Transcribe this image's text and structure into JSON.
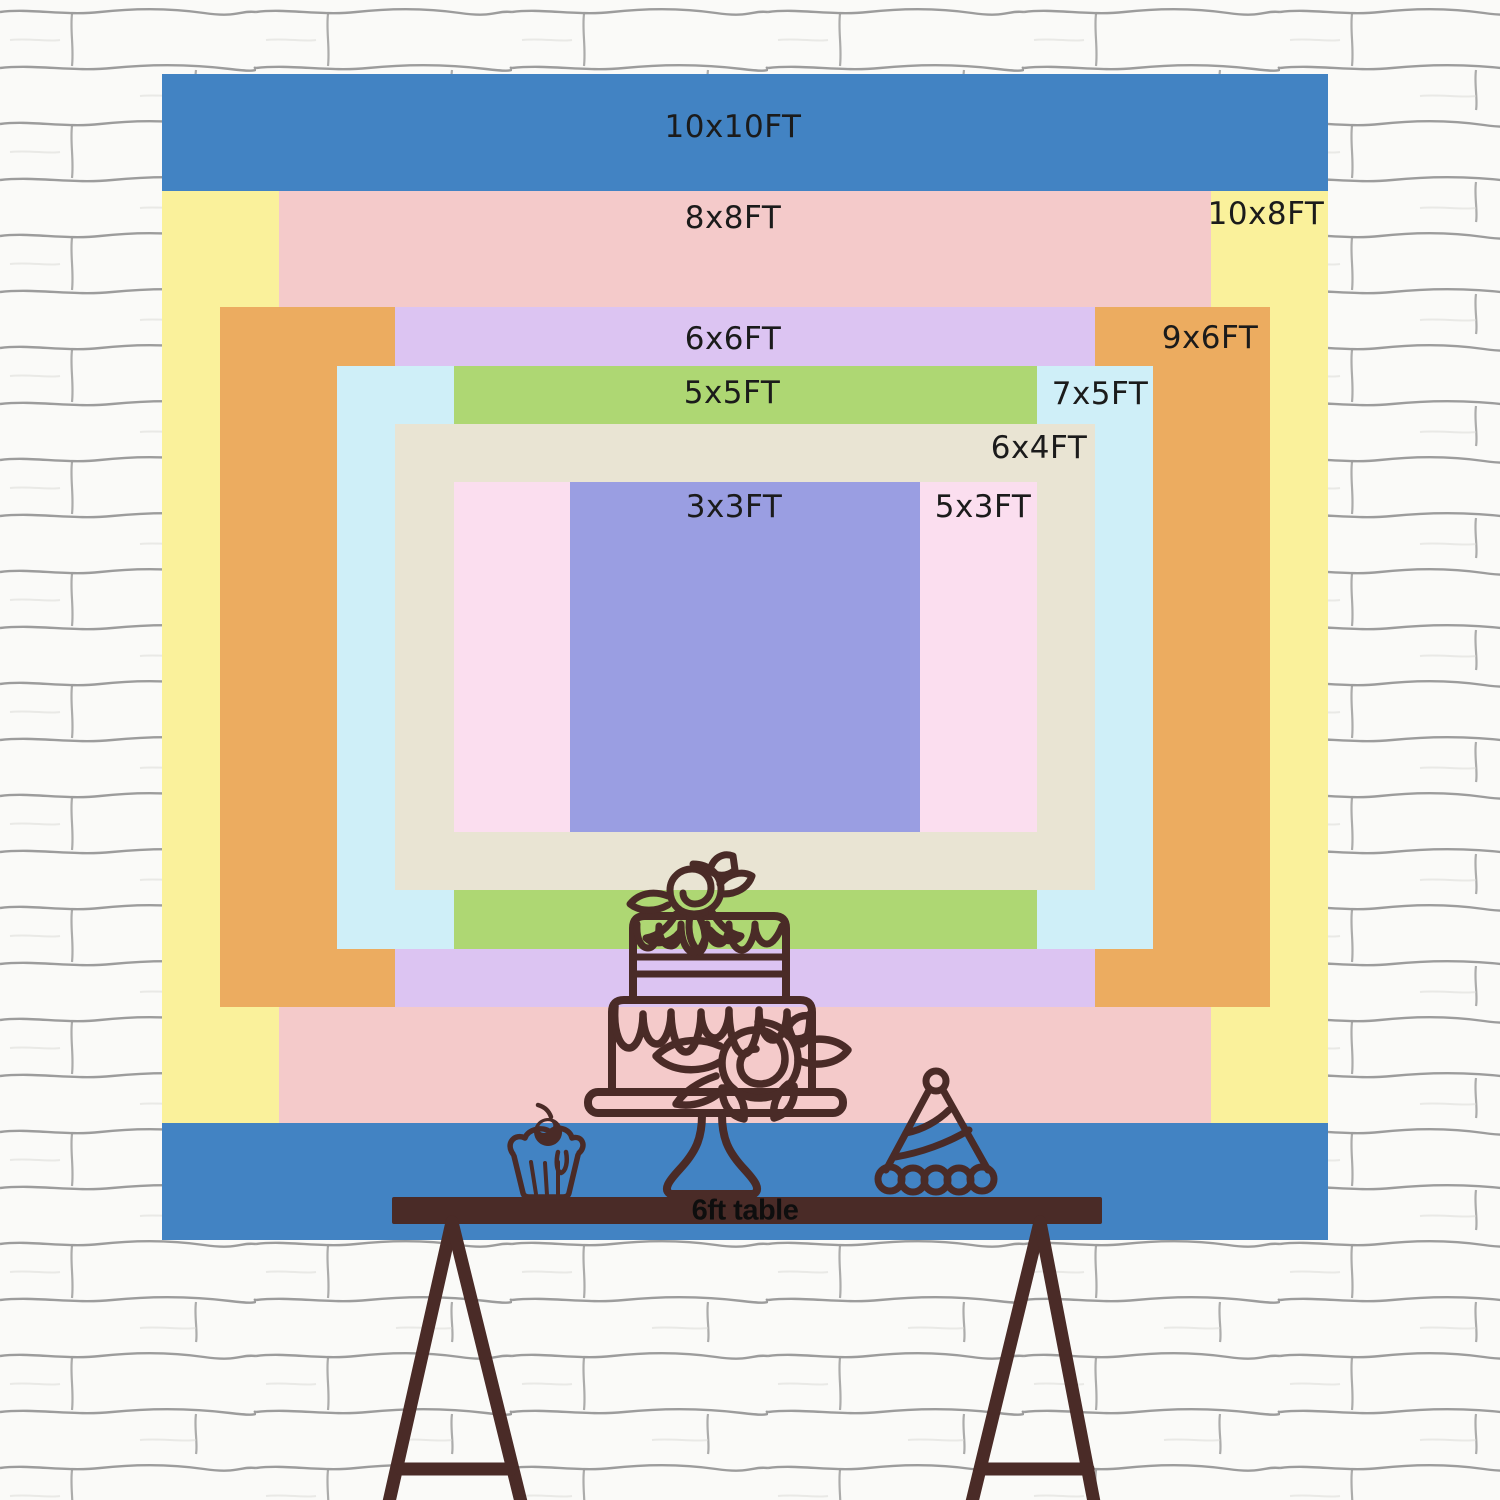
{
  "image_title": "Backdrop size comparison chart with 6ft table",
  "wall": {
    "background": "#fafaf8",
    "mortar_line_color": "#858585"
  },
  "chart": {
    "type": "nested-size-diagram",
    "unit": "FT",
    "px_per_ft": 116.6,
    "center": {
      "x": 745,
      "y": 657
    },
    "sizes": [
      {
        "label": "10x10FT",
        "width_ft": 10,
        "height_ft": 10,
        "color": "#4283c3",
        "label_x": 733,
        "label_y": 127
      },
      {
        "label": "10x8FT",
        "width_ft": 10,
        "height_ft": 8,
        "color": "#faf19b",
        "label_x": 1266,
        "label_y": 214
      },
      {
        "label": "8x8FT",
        "width_ft": 8,
        "height_ft": 8,
        "color": "#f4caca",
        "label_x": 733,
        "label_y": 218
      },
      {
        "label": "9x6FT",
        "width_ft": 9,
        "height_ft": 6,
        "color": "#ecac60",
        "label_x": 1210,
        "label_y": 338
      },
      {
        "label": "6x6FT",
        "width_ft": 6,
        "height_ft": 6,
        "color": "#dcc4f2",
        "label_x": 733,
        "label_y": 339
      },
      {
        "label": "7x5FT",
        "width_ft": 7,
        "height_ft": 5,
        "color": "#cfeff8",
        "label_x": 1100,
        "label_y": 394
      },
      {
        "label": "5x5FT",
        "width_ft": 5,
        "height_ft": 5,
        "color": "#aed773",
        "label_x": 732,
        "label_y": 393
      },
      {
        "label": "6x4FT",
        "width_ft": 6,
        "height_ft": 4,
        "color": "#e9e4d3",
        "label_x": 1039,
        "label_y": 448
      },
      {
        "label": "5x3FT",
        "width_ft": 5,
        "height_ft": 3,
        "color": "#fbdeef",
        "label_x": 983,
        "label_y": 507
      },
      {
        "label": "3x3FT",
        "width_ft": 3,
        "height_ft": 3,
        "color": "#9a9ee2",
        "label_x": 734,
        "label_y": 507
      }
    ]
  },
  "table": {
    "label": "6ft table",
    "color": "#4a2b27"
  },
  "illustration": {
    "line_color": "#4a2b27",
    "items": [
      "two-tier cake on stand",
      "cupcake with cherry",
      "party hat"
    ]
  }
}
